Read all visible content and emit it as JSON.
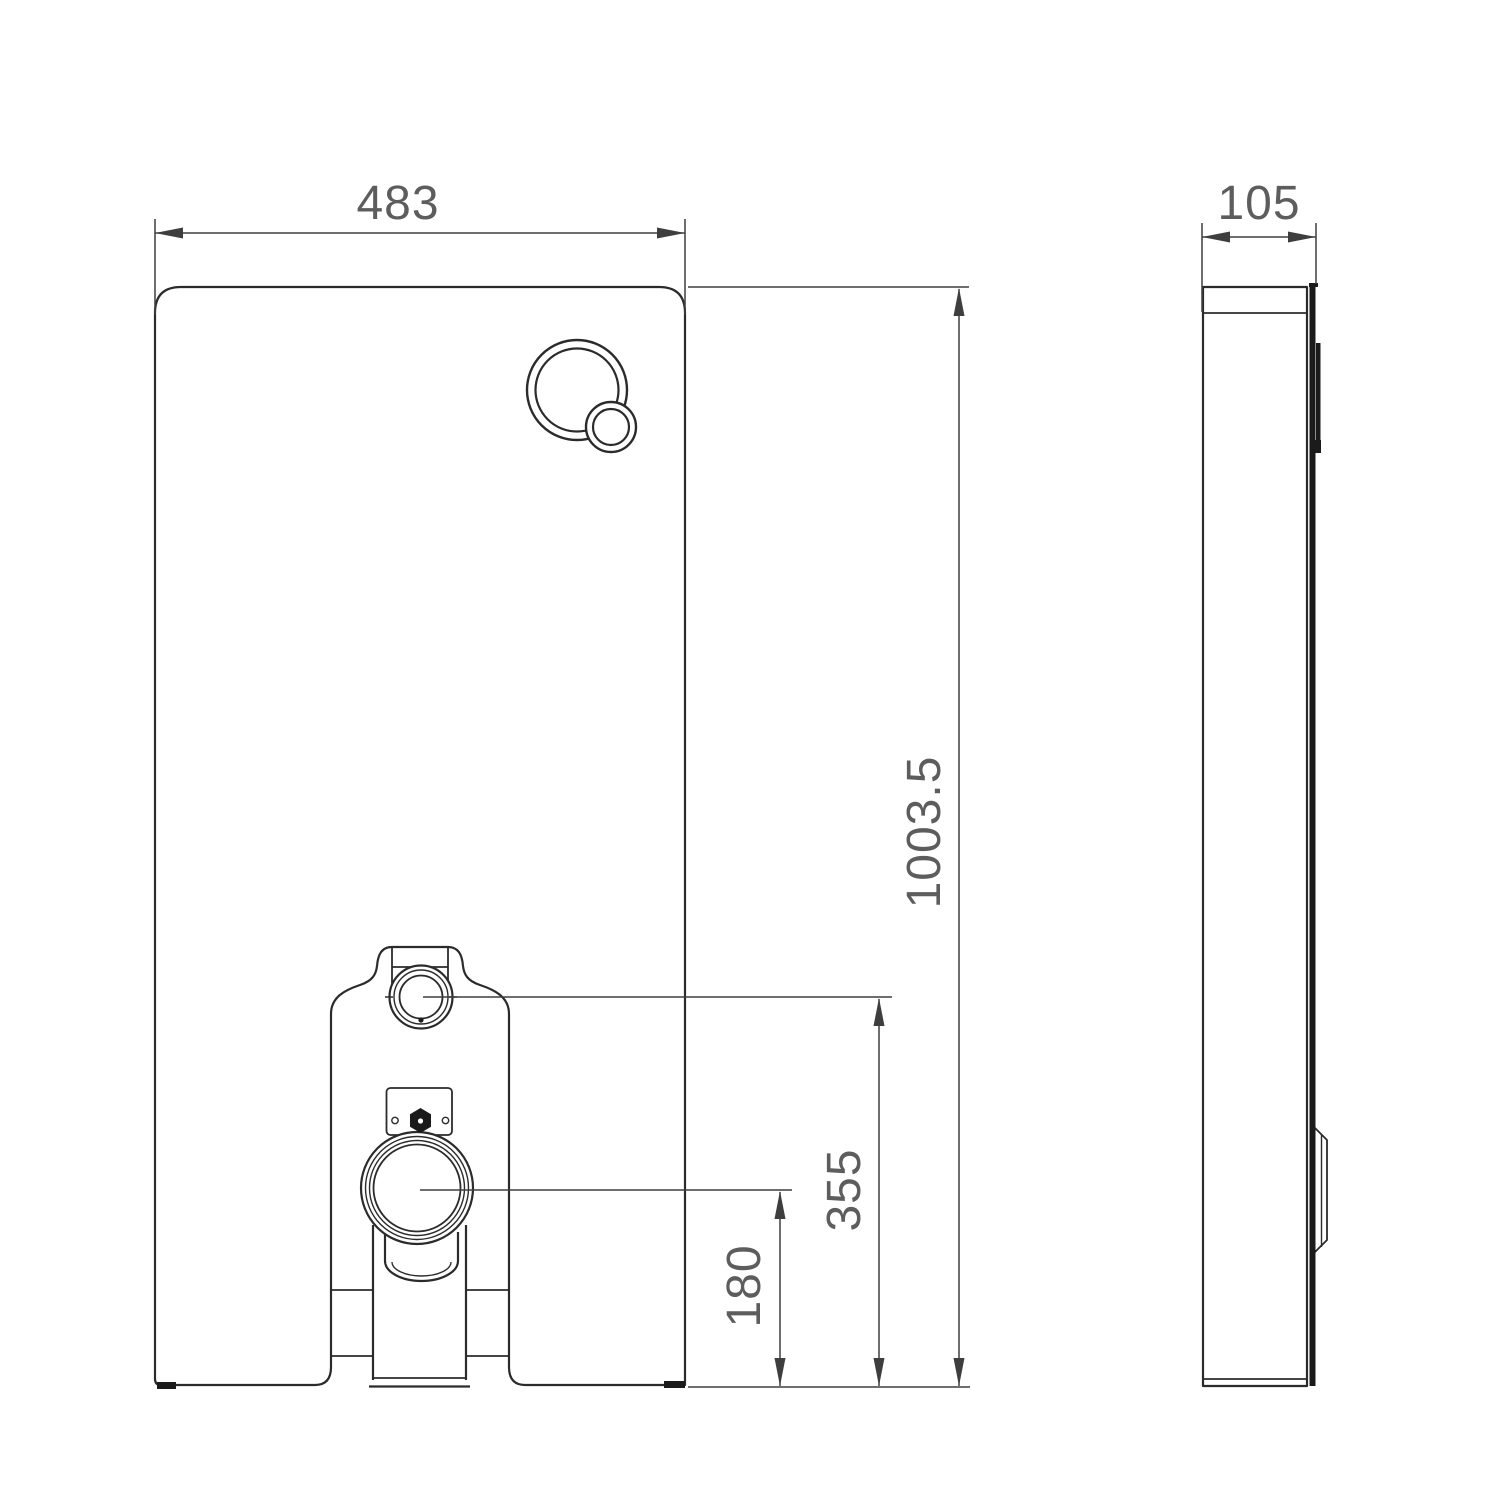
{
  "drawing": {
    "type": "technical-dimension-drawing",
    "views": {
      "front": "front elevation of sanitary module panel",
      "side": "side elevation of sanitary module panel"
    }
  },
  "dimensions": {
    "front_width": "483",
    "front_height": "1003.5",
    "supply_connection_height": "355",
    "outlet_connection_height": "180",
    "side_depth": "105"
  },
  "colors": {
    "line": "#2b2b2b",
    "dim": "#3e3e3e",
    "text": "#5d5d5d",
    "dark": "#1b1b1b",
    "background": "#ffffff"
  }
}
